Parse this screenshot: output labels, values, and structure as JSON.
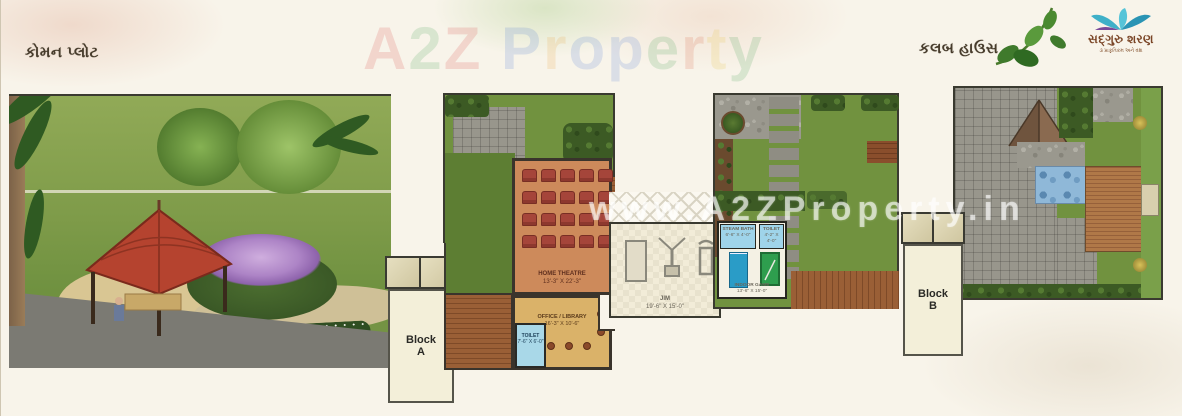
{
  "header": {
    "common_plot_label": "કોમન પ્લોટ",
    "club_house_label": "કલબ હાઉસ"
  },
  "brand": {
    "logo_letters": [
      {
        "ch": "A",
        "color": "#d64040"
      },
      {
        "ch": "2",
        "color": "#3f9e4f"
      },
      {
        "ch": "Z",
        "color": "#d64040"
      },
      {
        "ch": " ",
        "color": "#888888"
      },
      {
        "ch": "P",
        "color": "#4a77d4"
      },
      {
        "ch": "r",
        "color": "#e8a23a"
      },
      {
        "ch": "o",
        "color": "#4a77d4"
      },
      {
        "ch": "p",
        "color": "#4a77d4"
      },
      {
        "ch": "e",
        "color": "#3f9e4f"
      },
      {
        "ch": "r",
        "color": "#d66040"
      },
      {
        "ch": "t",
        "color": "#e6c23a"
      },
      {
        "ch": "y",
        "color": "#3f9e4f"
      }
    ],
    "watermark_url": "www.A2ZProperty.in"
  },
  "developer_logo": {
    "name": "સદ્ગુરુ શરણ",
    "tagline": "૩ પ્રાકૃતિકમ અને વંશ",
    "flower_color": "#3fb0c8",
    "accent_color": "#7a4a9a"
  },
  "rooms": {
    "home_theatre": {
      "name": "HOME THEATRE",
      "size": "13'-3\" X 22'-3\"",
      "seat_rows": 4,
      "seat_cols": 5
    },
    "office_library": {
      "name": "OFFICE / LIBRARY",
      "size": "16'-3\" X 10'-6\""
    },
    "toilet_main": {
      "name": "TOILET",
      "size": "7'-6\" X 6'-0\""
    },
    "gym": {
      "name": "JIM",
      "size": "19'-6\" X 15'-0\""
    },
    "steam_bath": {
      "name": "STEAM BATH",
      "size": "6'-6\" X 4'-0\""
    },
    "toilet_games": {
      "name": "TOILET",
      "size": "4'-2\" X 4'-0\""
    },
    "indoor_game": {
      "name": "INDOOR GAME",
      "size": "13'-6\" X 15'-0\""
    }
  },
  "blocks": {
    "a": {
      "line1": "Block",
      "line2": "A"
    },
    "b": {
      "line1": "Block",
      "line2": "B"
    }
  },
  "colors": {
    "lawn": "#71923f",
    "theatre_floor": "#cd8a5b",
    "seat": "#a5453a",
    "office_floor": "#dab269",
    "wet_area": "#9fd4ea",
    "pool": "#8fb8d8",
    "deck": "#9a5f36",
    "plan_border": "#3a3a30"
  }
}
